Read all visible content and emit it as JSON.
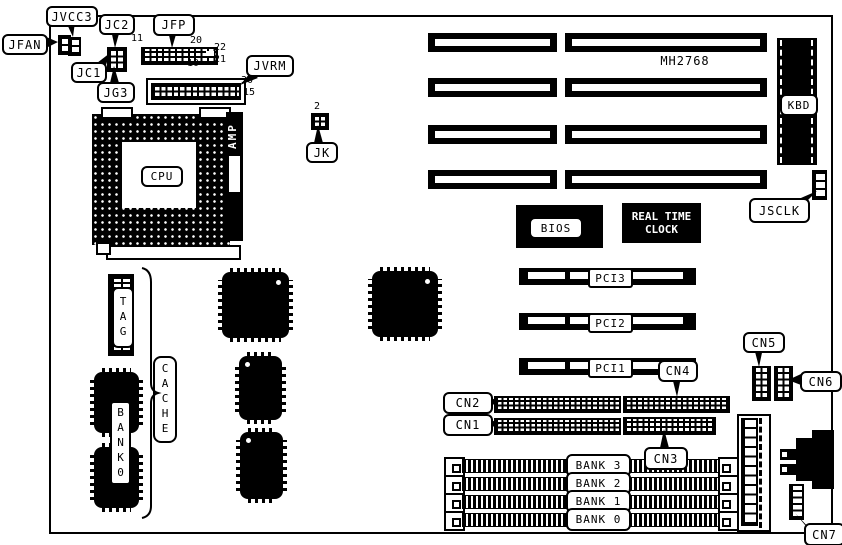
{
  "board": {
    "part_number": "MH2768",
    "callouts": {
      "jfan": "JFAN",
      "jvcc3": "JVCC3",
      "jc2": "JC2",
      "jc1": "JC1",
      "jg3": "JG3",
      "jfp": "JFP",
      "jvrm": "JVRM",
      "jk": "JK",
      "jsclk": "JSCLK",
      "cn1": "CN1",
      "cn2": "CN2",
      "cn3": "CN3",
      "cn4": "CN4",
      "cn5": "CN5",
      "cn6": "CN6",
      "cn7": "CN7"
    },
    "components": {
      "cpu": "CPU",
      "amp": "AMP",
      "kbd": "KBD",
      "bios": "BIOS",
      "rtc_line1": "REAL TIME",
      "rtc_line2": "CLOCK",
      "tag": "TAG",
      "cache": "CACHE",
      "cache_bank": "BANK0"
    },
    "pci_slots": [
      {
        "label": "PCI3"
      },
      {
        "label": "PCI2"
      },
      {
        "label": "PCI1"
      }
    ],
    "memory_banks": [
      {
        "label": "BANK 3"
      },
      {
        "label": "BANK 2"
      },
      {
        "label": "BANK 1"
      },
      {
        "label": "BANK 0"
      }
    ],
    "pin_numbers": {
      "jfp": {
        "p11": "11",
        "p20": "20",
        "p22": "22",
        "p21": "21",
        "p10": "10"
      },
      "jvrm": {
        "p30": "30",
        "p15": "15"
      },
      "jk": {
        "p2": "2"
      }
    },
    "colors": {
      "ink": "#000000",
      "paper": "#ffffff"
    }
  }
}
